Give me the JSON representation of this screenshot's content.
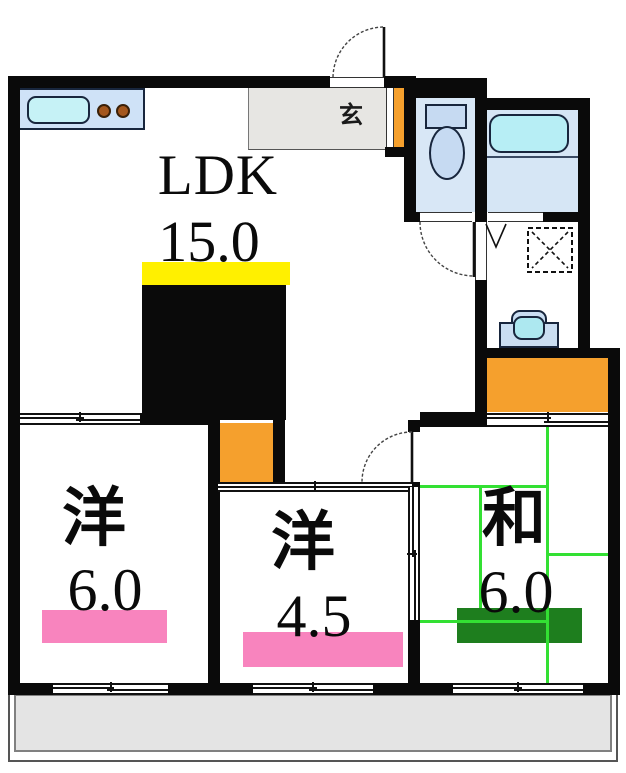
{
  "floorplan": {
    "title": "3LDK apartment floor plan",
    "rooms": {
      "ldk": {
        "label": "LDK",
        "size": "15.0"
      },
      "western1": {
        "label": "洋",
        "size": "6.0"
      },
      "western2": {
        "label": "洋",
        "size": "4.5"
      },
      "japanese": {
        "label": "和",
        "size": "6.0"
      },
      "genkan": {
        "label": "玄"
      }
    },
    "colors": {
      "wall": "#0a0a0a",
      "ldk_highlight": "#FFF000",
      "western_highlight": "#F884BE",
      "japanese_highlight": "#1E7E1E",
      "tatami_line": "#33E033",
      "closet_orange": "#F5A02D",
      "water_room_blue": "#D8E7F6",
      "fixture_cyan": "#B7EEF5",
      "genkan_gray": "#E7E6E3",
      "balcony_gray": "#E4E4E4"
    }
  }
}
